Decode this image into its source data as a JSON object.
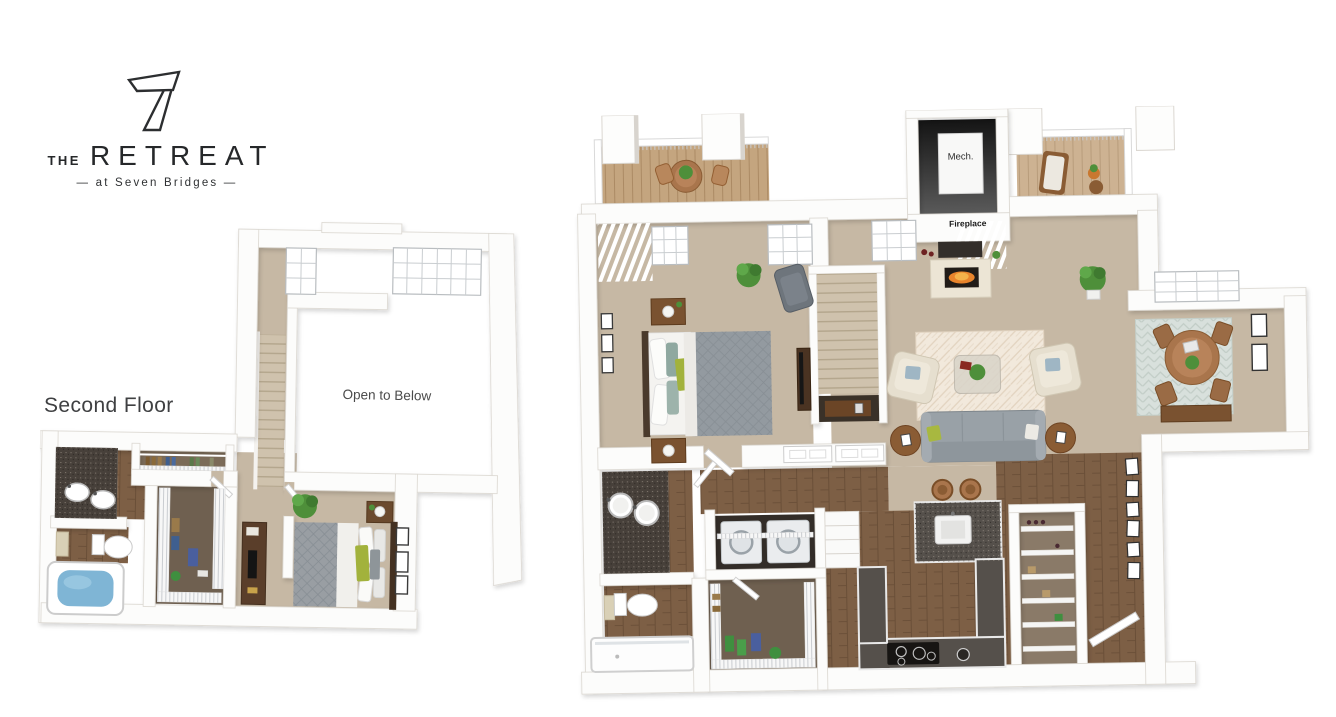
{
  "logo": {
    "brand_prefix": "THE",
    "brand_name": "RETREAT",
    "tagline": "— at Seven Bridges —",
    "mark": "seven-glyph"
  },
  "plans": {
    "second_floor": {
      "label": "Second Floor",
      "open_to_below": "Open to Below"
    },
    "first_floor": {
      "mech": "Mech.",
      "fireplace": "Fireplace"
    }
  },
  "palette": {
    "background": "#ffffff",
    "wall": "#fcfcfb",
    "wall_edge": "#dad6d0",
    "carpet_tan": "#c6b8a4",
    "wood_floor": "#7d5f45",
    "deck_wood": "#c4a57f",
    "counter_dark": "#55504b",
    "vanity_dark": "#47403a",
    "accent_green": "#a8b840",
    "sofa_gray": "#99a1a7",
    "duvet_gray": "#939aa0",
    "water_blue": "#7fb5d5",
    "plant_green": "#4e8f3a",
    "rug_cream": "#f2e9dc",
    "rug_teal": "#d8e0dc",
    "flame_orange": "#e8842c",
    "text_dark": "#2d2f31"
  }
}
